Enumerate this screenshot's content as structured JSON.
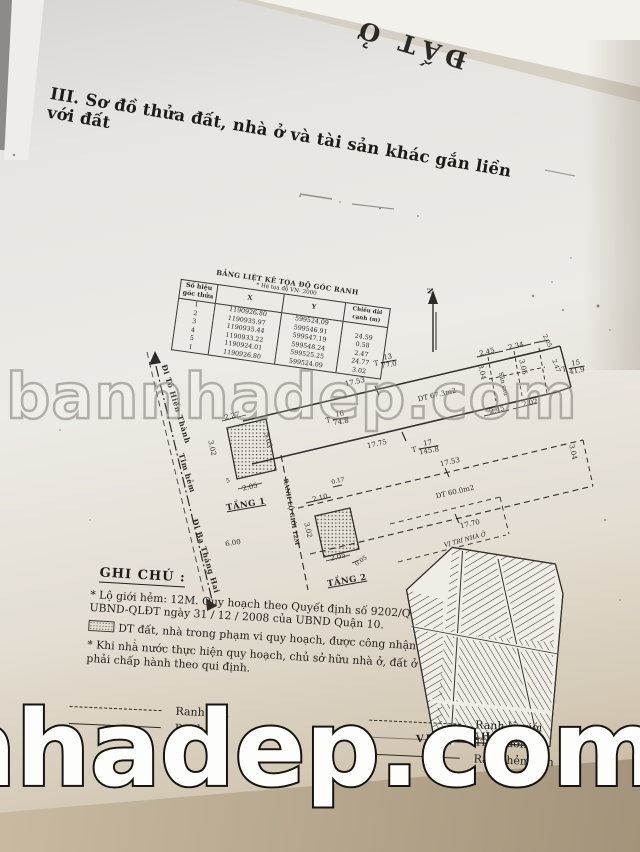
{
  "photo": {
    "back_sheet_text": "ĐẤT Ở",
    "watermark_mid": "bannhadep.com",
    "watermark_bottom": "nhadep.com"
  },
  "title": "III. Sơ đồ thửa đất, nhà ở và tài sản khác gắn liền với đất",
  "coord_table": {
    "title": "BẢNG LIỆT KÊ TỌA ĐỘ GÓC RANH",
    "subtitle": "* Hệ tọa độ VN- 2000",
    "col_corner": "Số hiệu góc thửa",
    "col_x": "X",
    "col_y": "Y",
    "col_len": "Chiều dài cạnh (m)",
    "rows": [
      {
        "id": "1",
        "x": "1190926.80",
        "y": "599524.09",
        "len": ""
      },
      {
        "id": "2",
        "x": "1190935.97",
        "y": "599546.91",
        "len": "24.59"
      },
      {
        "id": "3",
        "x": "1190935.44",
        "y": "599547.19",
        "len": "0.58"
      },
      {
        "id": "4",
        "x": "1190933.22",
        "y": "599548.24",
        "len": "2.47"
      },
      {
        "id": "5",
        "x": "1190924.01",
        "y": "599525.25",
        "len": "24.77"
      },
      {
        "id": "1",
        "x": "1190926.80",
        "y": "599524.09",
        "len": "3.02"
      }
    ]
  },
  "plan": {
    "labels": [
      {
        "name": "north-letter",
        "t": "N",
        "x": 430,
        "y": 291,
        "r": 90,
        "cls": "b"
      },
      {
        "name": "survey-point-13",
        "pre": "T",
        "top": "13",
        "bot": "77.0",
        "x": 385,
        "y": 362,
        "r": -10
      },
      {
        "name": "dim",
        "t": "17.53",
        "x": 355,
        "y": 382,
        "r": -13
      },
      {
        "name": "area-lot",
        "t": "DT 67.3m2",
        "x": 437,
        "y": 395,
        "r": -13
      },
      {
        "name": "survey-point-16",
        "pre": "T",
        "top": "16",
        "bot": "74.8",
        "x": 337,
        "y": 419,
        "r": -10
      },
      {
        "name": "dim",
        "t": "17.75",
        "x": 377,
        "y": 444,
        "r": -13
      },
      {
        "name": "survey-point-17",
        "pre": "T",
        "top": "17",
        "bot": "145.8",
        "x": 425,
        "y": 448,
        "r": -10
      },
      {
        "name": "dim",
        "t": "17.53",
        "x": 450,
        "y": 462,
        "r": -13
      },
      {
        "name": "area-floor2",
        "t": "DT 60.0m2",
        "x": 455,
        "y": 492,
        "r": -13
      },
      {
        "name": "dim",
        "t": "17.70",
        "x": 470,
        "y": 524,
        "r": -13
      },
      {
        "name": "dim",
        "t": "2.27",
        "x": 232,
        "y": 416,
        "r": -13
      },
      {
        "name": "dim",
        "t": "3.02",
        "x": 212,
        "y": 448,
        "r": 77
      },
      {
        "name": "dim",
        "t": "3.03",
        "x": 268,
        "y": 440,
        "r": 77
      },
      {
        "name": "corner-5",
        "t": "5",
        "x": 228,
        "y": 481,
        "r": -13,
        "cls": "t"
      },
      {
        "name": "dim",
        "t": "2.05",
        "x": 250,
        "y": 487,
        "r": -13
      },
      {
        "name": "dim",
        "t": "6.00",
        "x": 233,
        "y": 543,
        "r": -8
      },
      {
        "name": "floor1-label",
        "t": "TẦNG 1",
        "x": 246,
        "y": 505,
        "r": -10,
        "cls": "fl"
      },
      {
        "name": "setback-line-label",
        "t": "RANH LỘ GIỚI 12M",
        "x": 291,
        "y": 512,
        "r": 80,
        "cls": "t b"
      },
      {
        "name": "dim",
        "t": "0.17",
        "x": 338,
        "y": 481,
        "r": -13,
        "cls": "t"
      },
      {
        "name": "dim",
        "t": "2.10",
        "x": 320,
        "y": 498,
        "r": -13
      },
      {
        "name": "dim",
        "t": "3.02",
        "x": 308,
        "y": 530,
        "r": 77
      },
      {
        "name": "dim",
        "t": "2.05",
        "x": 338,
        "y": 557,
        "r": -13
      },
      {
        "name": "dim",
        "t": "0.05",
        "x": 361,
        "y": 561,
        "r": -35,
        "cls": "t"
      },
      {
        "name": "floor2-label",
        "t": "TẦNG 2",
        "x": 347,
        "y": 581,
        "r": -10,
        "cls": "fl"
      },
      {
        "name": "dim",
        "t": "2.45",
        "x": 487,
        "y": 352,
        "r": -13
      },
      {
        "name": "dim",
        "t": "2.34",
        "x": 516,
        "y": 346,
        "r": -13
      },
      {
        "name": "dim",
        "t": "2.05",
        "x": 547,
        "y": 341,
        "r": 65,
        "cls": "t"
      },
      {
        "name": "dim",
        "t": "3.04",
        "x": 482,
        "y": 372,
        "r": 77
      },
      {
        "name": "yard-label",
        "t": "Sân sau",
        "x": 503,
        "y": 384,
        "r": 77,
        "cls": "t"
      },
      {
        "name": "dim",
        "t": "3.05",
        "x": 523,
        "y": 367,
        "r": 77
      },
      {
        "name": "dim",
        "t": "2.47",
        "x": 556,
        "y": 366,
        "r": 70,
        "cls": "t"
      },
      {
        "name": "survey-point-15",
        "pre": "T",
        "top": "15",
        "bot": "41.9",
        "x": 573,
        "y": 368,
        "r": -10
      },
      {
        "name": "dim",
        "t": "2.45",
        "x": 497,
        "y": 410,
        "r": -13
      },
      {
        "name": "dim",
        "t": "2.02",
        "x": 530,
        "y": 403,
        "r": -13
      },
      {
        "name": "dim",
        "t": "3.04",
        "x": 573,
        "y": 452,
        "r": 77
      },
      {
        "name": "map-pointer-label",
        "t": "VỊ TRÍ NHÀ Ở",
        "x": 465,
        "y": 540,
        "r": -15,
        "cls": "t i"
      },
      {
        "name": "alley-dir-north",
        "t": "Đi Tô Hiến Thành",
        "x": 176,
        "y": 404,
        "r": 73,
        "cls": "alley"
      },
      {
        "name": "alley-center-label",
        "t": "Tim hẻm",
        "x": 187,
        "y": 473,
        "r": 73,
        "cls": "alley"
      },
      {
        "name": "alley-dir-south",
        "t": "Đi Ba Tháng Hai",
        "x": 206,
        "y": 556,
        "r": 73,
        "cls": "alley"
      }
    ]
  },
  "notes": {
    "heading": "GHI CHÚ :",
    "item1": "* Lộ giới hẻm: 12M. Quy hoạch theo Quyết định số 9202/QĐ-UBND-QLĐT ngày 31 / 12 / 2008 của UBND Quận 10.",
    "item2": "DT đất, nhà trong phạm vi quy hoạch, được công nhận.",
    "item3": "* Khi nhà nước thực hiện quy hoạch, chủ sở hữu nhà ở, đất ở phải chấp hành theo qui định."
  },
  "legend": {
    "ranh_nha": "Ranh nhà",
    "ranh_dat": "Ranh đất",
    "ranh_lo_gioi": "Ranh lộ giới",
    "tim_duong": "Tim đường",
    "ranh_hem_con": "Ranh hẻm con"
  },
  "map": {
    "caption": "VỊ TRÍ NHÀ ĐẤT"
  }
}
